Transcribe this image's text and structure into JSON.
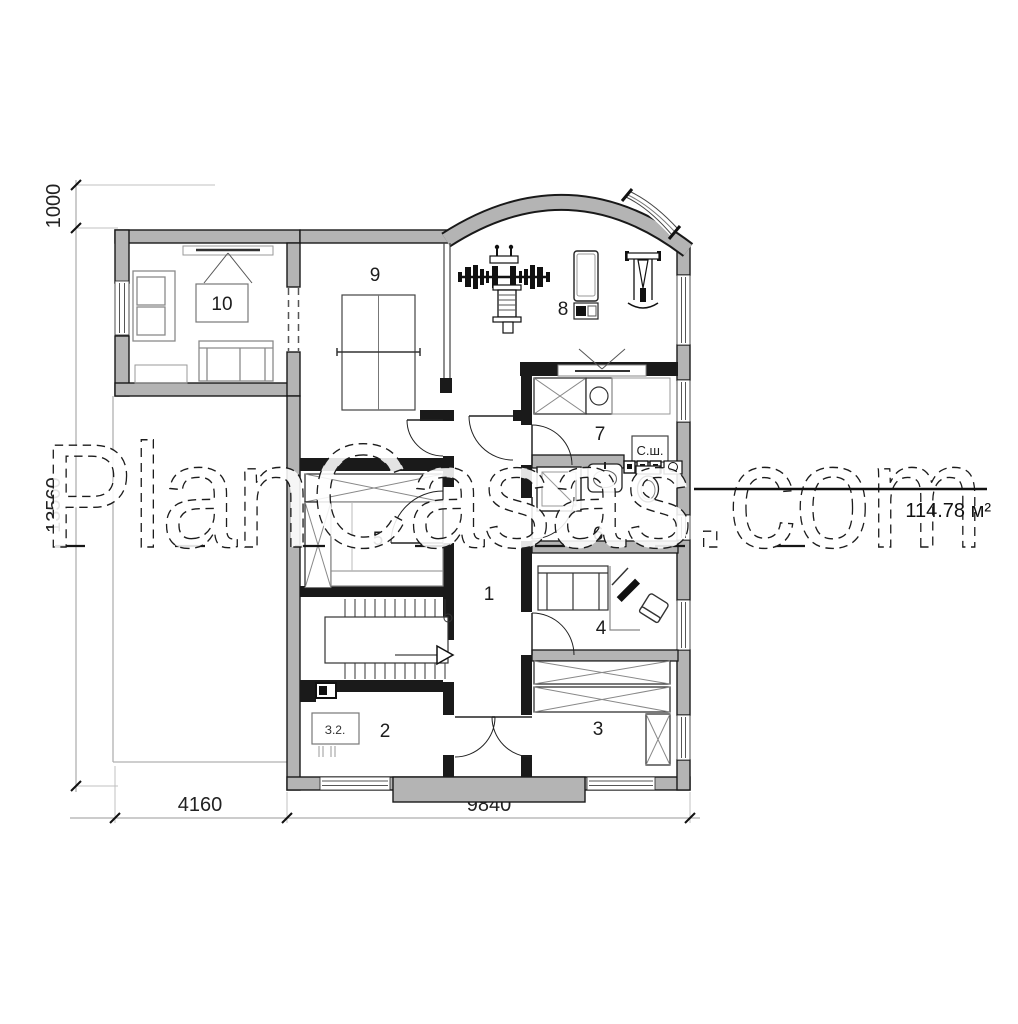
{
  "watermark": {
    "text": "PlanCasas.com"
  },
  "plan": {
    "area_label": "114.78 м²",
    "labels": {
      "drying_cabinet": "С.ш.",
      "panel": "З.2."
    },
    "dimensions": {
      "top_offset": "1000",
      "total_height": "13560",
      "left_width": "4160",
      "right_width": "9840"
    },
    "rooms": {
      "r1": "1",
      "r2": "2",
      "r3": "3",
      "r4": "4",
      "r5": "5",
      "r6": "6",
      "r7": "7",
      "r8": "8",
      "r9": "9",
      "r10": "10"
    },
    "colors": {
      "wall_fill": "#b4b4b4",
      "wall_edge": "#191919",
      "background": "#ffffff"
    }
  }
}
